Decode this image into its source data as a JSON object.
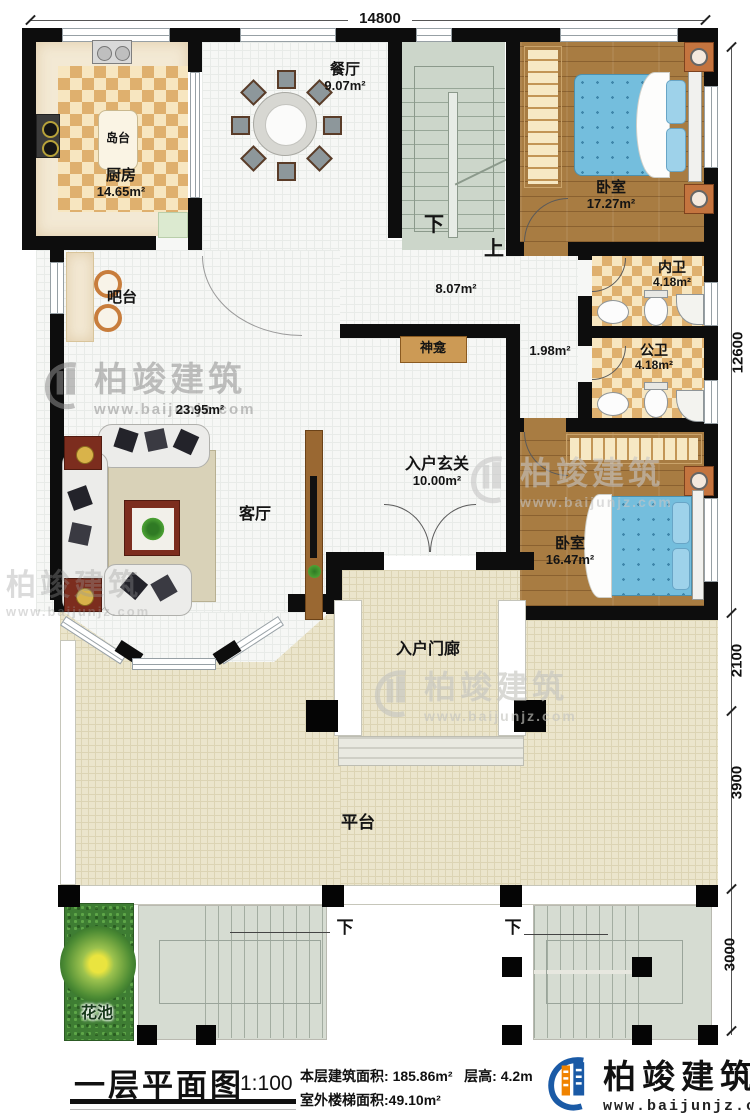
{
  "dimensions": {
    "top": "14800",
    "right": [
      "12600",
      "2100",
      "3900",
      "3000"
    ]
  },
  "rooms": {
    "kitchen": {
      "name": "厨房",
      "area": "14.65m²"
    },
    "island": {
      "name": "岛台"
    },
    "dining": {
      "name": "餐厅",
      "area": "9.07m²"
    },
    "bedroom1": {
      "name": "卧室",
      "area": "17.27m²"
    },
    "inner_bath": {
      "name": "内卫",
      "area": "4.18m²"
    },
    "public_bath": {
      "name": "公卫",
      "area": "4.18m²"
    },
    "hall": {
      "area": "8.07m²"
    },
    "corridor": {
      "area": "1.98m²"
    },
    "shrine": {
      "name": "神龛"
    },
    "foyer": {
      "name": "入户玄关",
      "area": "10.00m²"
    },
    "bar": {
      "name": "吧台"
    },
    "living": {
      "name": "客厅",
      "area": "23.95m²"
    },
    "bedroom2": {
      "name": "卧室",
      "area": "16.47m²"
    },
    "porch": {
      "name": "入户门廊"
    },
    "platform": {
      "name": "平台"
    },
    "flower_bed": {
      "name": "花池"
    }
  },
  "stairs": {
    "down": "下",
    "up": "上"
  },
  "titleblock": {
    "title": "一层平面图",
    "scale": "1:100",
    "floor_area_label": "本层建筑面积:",
    "floor_area_value": "185.86m²",
    "floor_height_label": "层高:",
    "floor_height_value": "4.2m",
    "stair_area_label": "室外楼梯面积:",
    "stair_area_value": "49.10m²"
  },
  "brand": {
    "name": "柏竣建筑",
    "url": "www.baijunjz.com"
  }
}
